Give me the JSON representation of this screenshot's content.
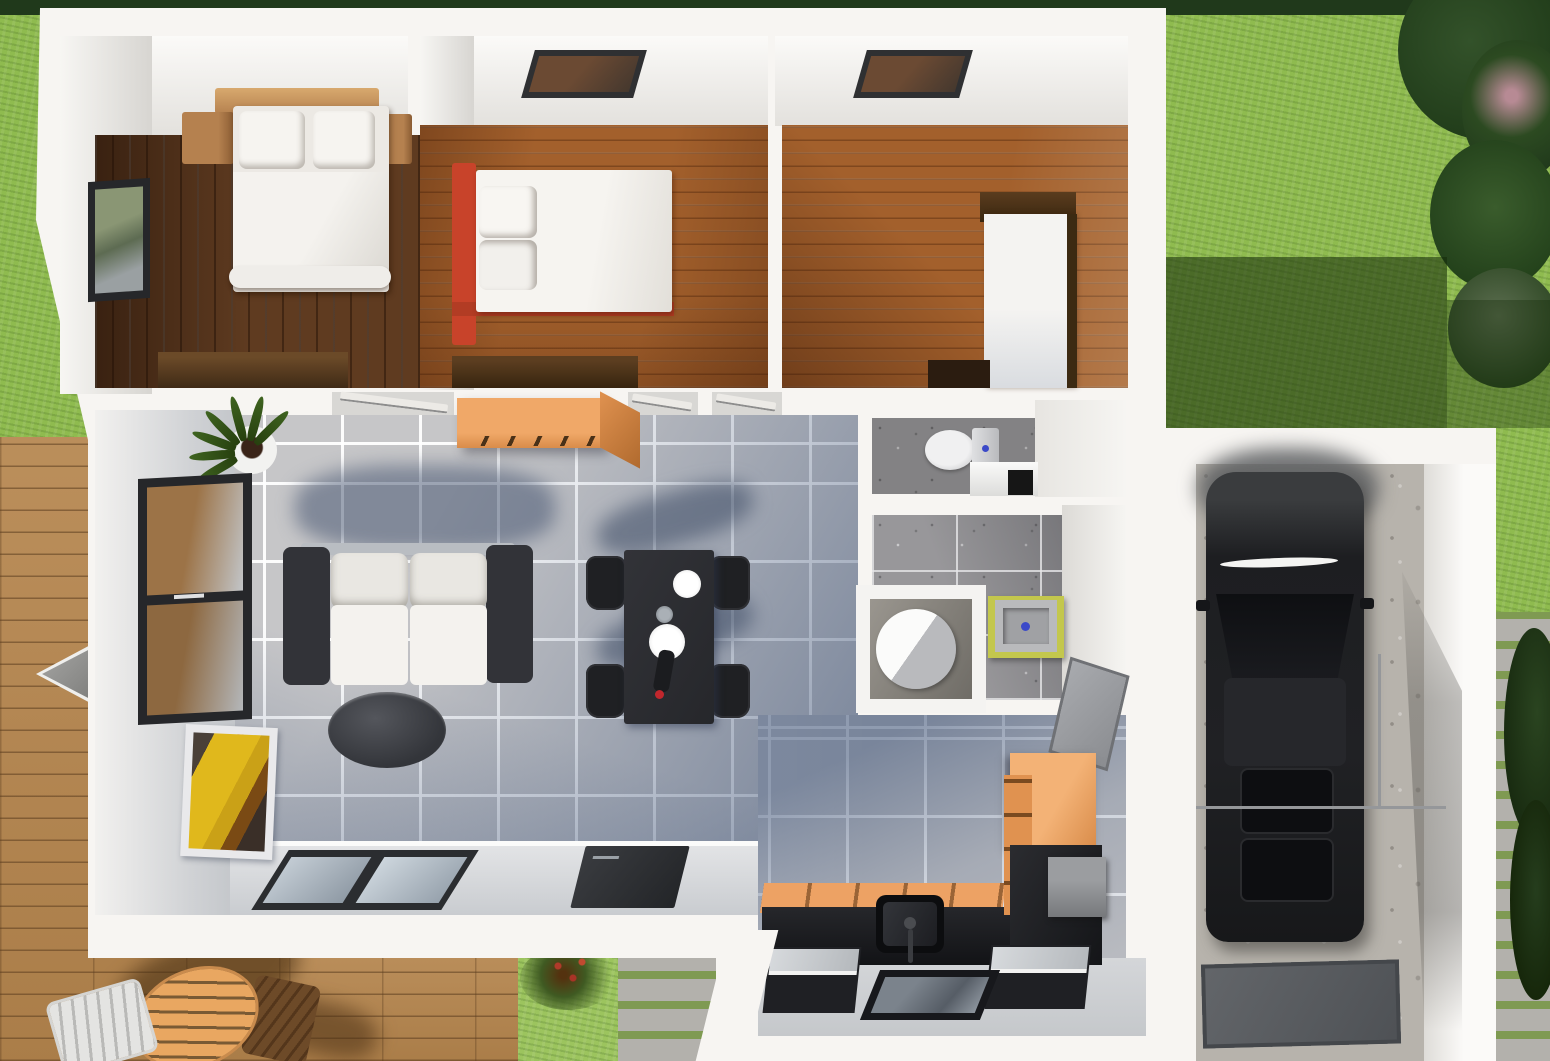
{
  "scene": {
    "kind": "3d-architectural-floor-plan-render",
    "view": "top-down aerial",
    "width_px": 1550,
    "height_px": 1061,
    "visible_text": "none"
  },
  "palette": {
    "grass": "#8fbb4f",
    "grass_shadow": "#3f6423",
    "hedge": "#20391b",
    "foliage": "#2c4a21",
    "deck": "#b5854d",
    "cobble": "#b3b1ac",
    "wall": "#f7f5f2",
    "tile": "#c6c6c8",
    "tile_shadow": "#5d7095",
    "wood_dark": "#5f3b20",
    "wood_orange": "#a3602c",
    "cabinet_orange": "#eca264",
    "counter_dark": "#1b1c20",
    "sofa_frame": "#323338",
    "cushion_white": "#f1efeb",
    "bed_red": "#c8432a",
    "basin_green": "#c3c74d",
    "car_black": "#1a1b1d",
    "concrete": "#b7b3ac",
    "glass_blue": "#b8c4ce"
  },
  "outdoor": {
    "areas": [
      {
        "id": "lawn",
        "name": "Lawn with building shadow"
      },
      {
        "id": "hedge",
        "name": "Hedge along top edge"
      },
      {
        "id": "trees",
        "name": "Tree and shrub cluster top right"
      },
      {
        "id": "deck",
        "name": "Wooden deck terrace left"
      },
      {
        "id": "patio_set",
        "name": "Round slatted patio table with chairs"
      },
      {
        "id": "parasol",
        "name": "Folded grey parasol"
      },
      {
        "id": "flower_patch",
        "name": "Grass patch with flowering shrub"
      },
      {
        "id": "cobble_path_bottom",
        "name": "Cobblestone path bottom"
      },
      {
        "id": "cobble_path_right",
        "name": "Cobblestone path right with bush"
      }
    ]
  },
  "rooms": [
    {
      "id": "bedroom-1",
      "name": "Bedroom 1 (dark wood floor)",
      "furniture": [
        "double bed with white duvet",
        "two pillows",
        "wood headboard shelf",
        "left nightstand",
        "right nightstand",
        "wall window",
        "low dresser"
      ]
    },
    {
      "id": "bedroom-2",
      "name": "Bedroom 2 (orange wood floor)",
      "furniture": [
        "bed with red frame",
        "two stacked pillows",
        "ceiling skylight",
        "low dresser"
      ]
    },
    {
      "id": "bedroom-3",
      "name": "Bedroom 3 (orange wood floor)",
      "furniture": [
        "white single bed with dark headboard",
        "tall dark wardrobe",
        "ceiling skylight",
        "low bench"
      ]
    },
    {
      "id": "living-room",
      "name": "Open plan living / dining room (grey tiles)",
      "furniture": [
        "two-seat sofa dark frame white cushions",
        "oval dark coffee table",
        "dark dining table with plates and bottle",
        "four black chairs",
        "potted plant",
        "side window",
        "leaning picture",
        "orange wall sideboard",
        "sliding glass door",
        "dark entry door"
      ]
    },
    {
      "id": "wc",
      "name": "Toilet room",
      "furniture": [
        "toilet with cistern",
        "low white cabinet",
        "dark wall niche"
      ]
    },
    {
      "id": "bathroom",
      "name": "Bathroom (grey tile floor)",
      "furniture": [
        "green washbasin unit",
        "round shower in alcove"
      ]
    },
    {
      "id": "kitchen",
      "name": "Kitchen (shadowed grey tiles)",
      "furniture": [
        "orange base cabinets",
        "dark worktop with sink",
        "tall orange cabinet",
        "grey appliance",
        "two dark island units with glass tops",
        "glass floor hatch",
        "grey door leaf on wall"
      ]
    },
    {
      "id": "garage",
      "name": "Garage (concrete floor)",
      "furniture": [
        "black car seen from above",
        "thin railing",
        "dark floor mat"
      ]
    }
  ]
}
